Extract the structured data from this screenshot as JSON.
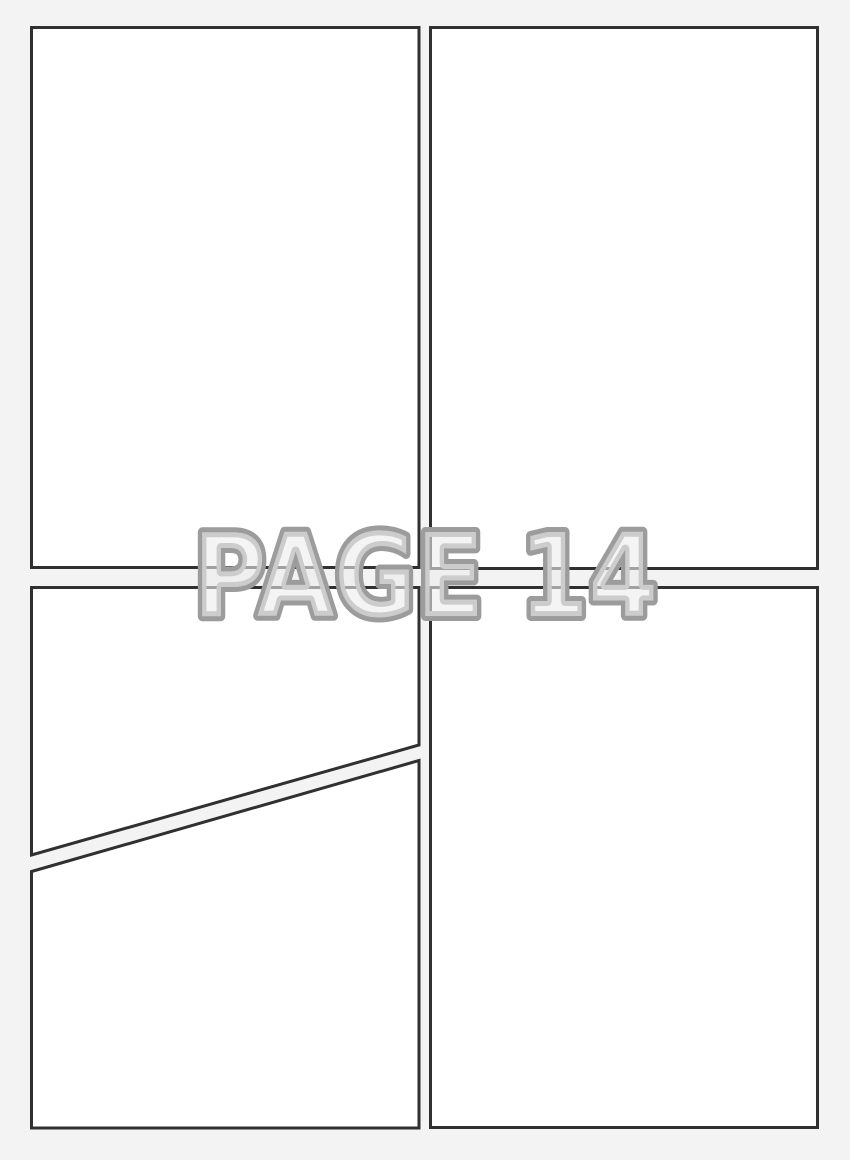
{
  "watermark": {
    "label": "PAGE 14",
    "page_number": "14"
  },
  "panels": {
    "count": 5,
    "ids": [
      "panel-top-left",
      "panel-top-right",
      "panel-bottom-left-upper",
      "panel-bottom-left-lower",
      "panel-bottom-right"
    ]
  },
  "colors": {
    "page_background": "#f3f3f3",
    "panel_fill": "#ffffff",
    "panel_border": "#303030",
    "watermark_outline": "#9c9c9c",
    "watermark_fill": "#ececec"
  }
}
